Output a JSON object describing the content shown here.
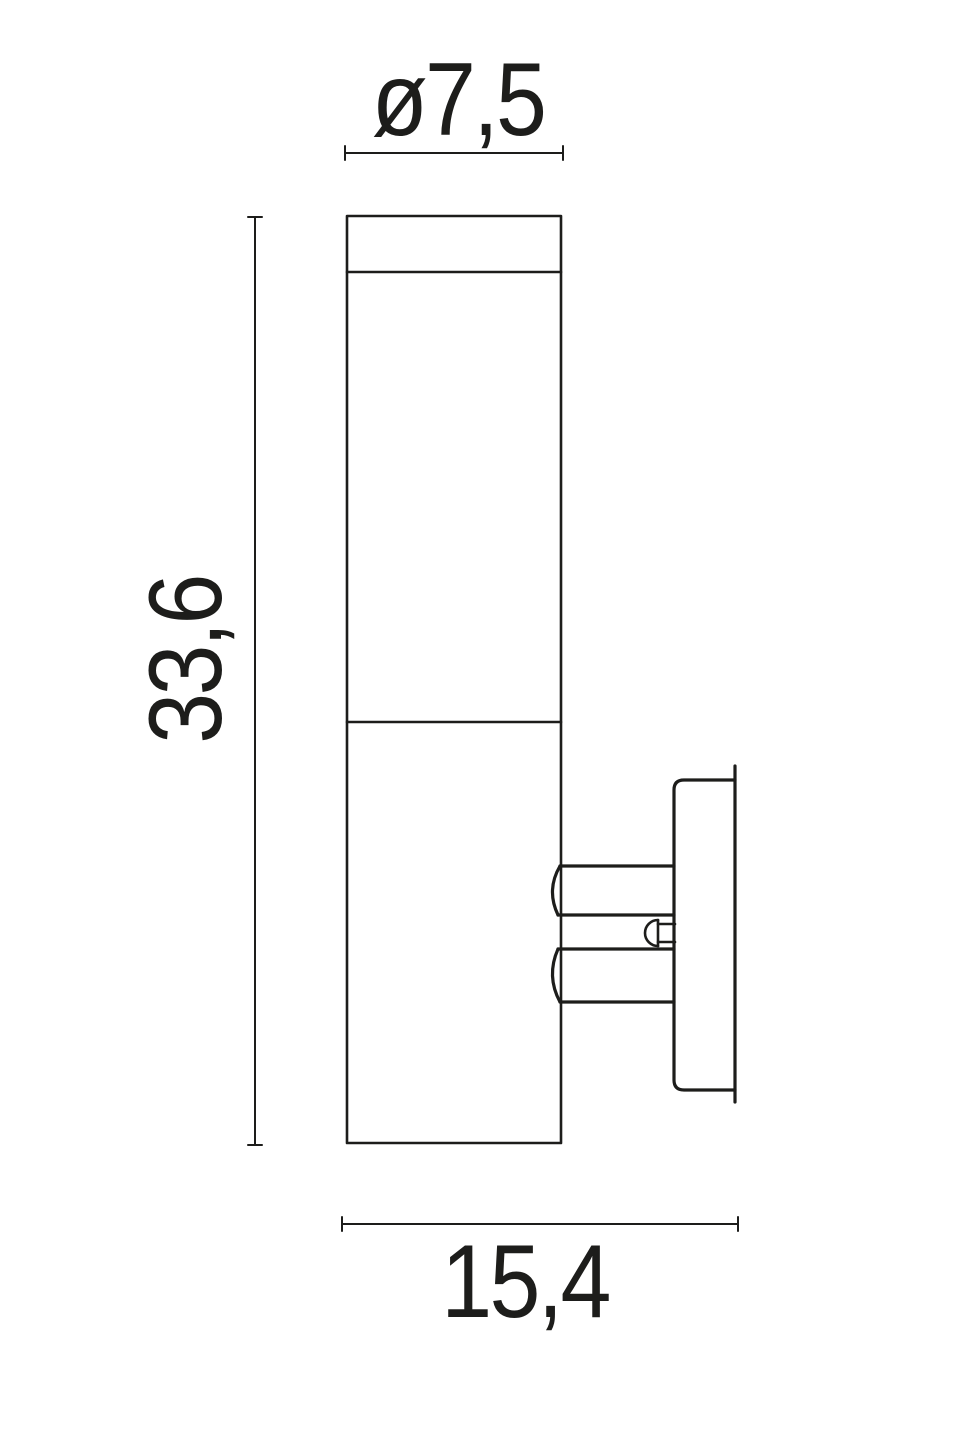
{
  "drawing": {
    "background_color": "#ffffff",
    "line_color": "#1d1d1b",
    "labels": {
      "diameter": "ø7,5",
      "height": "33,6",
      "width": "15,4"
    }
  }
}
